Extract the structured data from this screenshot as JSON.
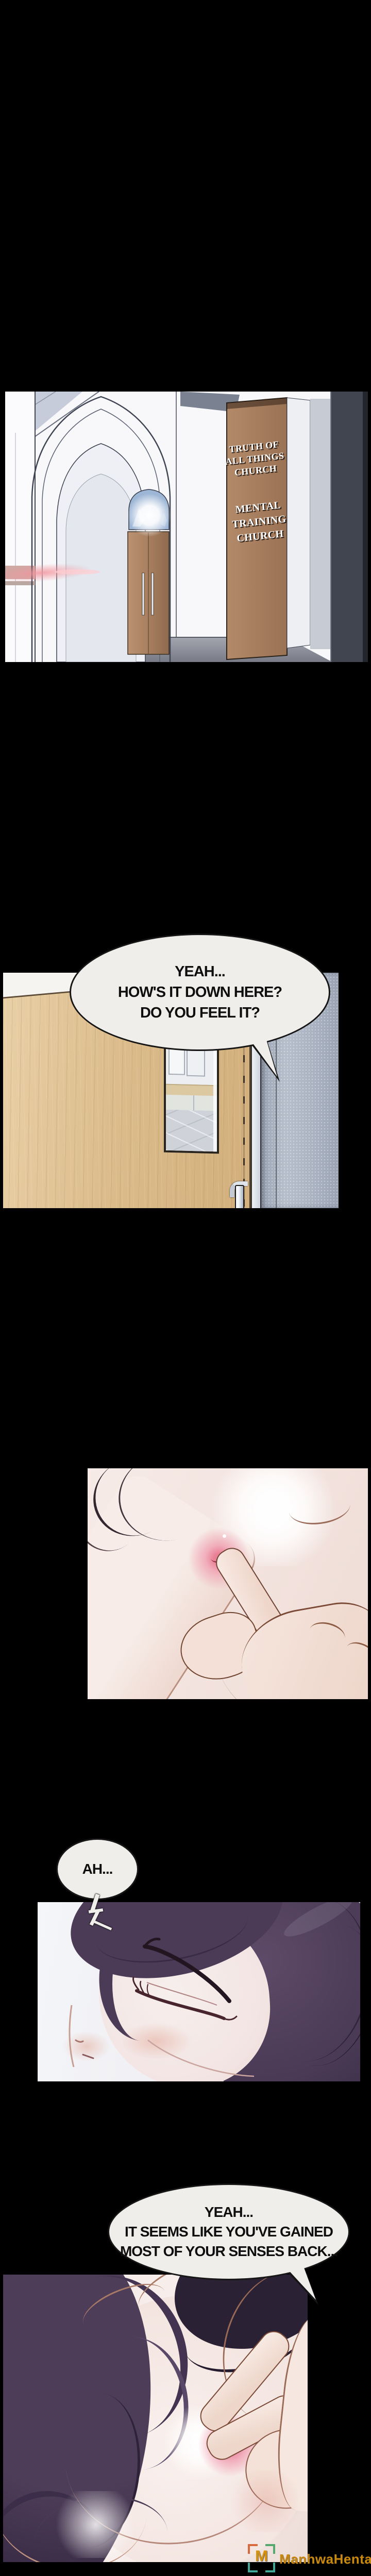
{
  "church_sign": {
    "top": [
      "TRUTH OF",
      "ALL THINGS",
      "CHURCH"
    ],
    "bottom": [
      "MENTAL",
      "TRAINING",
      "CHURCH"
    ]
  },
  "bubbles": {
    "door": {
      "lines": [
        "YEAH...",
        "HOW'S IT DOWN HERE?",
        "DO YOU FEEL IT?"
      ]
    },
    "ah": {
      "lines": [
        "AH..."
      ]
    },
    "senses": {
      "lines": [
        "YEAH...",
        "IT SEEMS LIKE YOU'VE GAINED",
        "MOST OF YOUR SENSES BACK..."
      ]
    }
  },
  "watermark": {
    "logo_letter": "M",
    "site_name": "ManhwaHentai",
    "text_color": "#c8890e",
    "logo_color": "#d8940f",
    "frame_orange": "#d96a3f",
    "frame_teal": "#41a89a"
  },
  "colors": {
    "page_background": "#000000",
    "bubble_fill": "#efeeeb",
    "bubble_border": "#161616",
    "sign_board": "#a97f63",
    "sign_text": "#ffffff",
    "door_wood": "#dcbc8c",
    "hair_purple": "#4a3a55",
    "skin": "#f3e8e6",
    "nipple_pink": "#ee9fae"
  }
}
